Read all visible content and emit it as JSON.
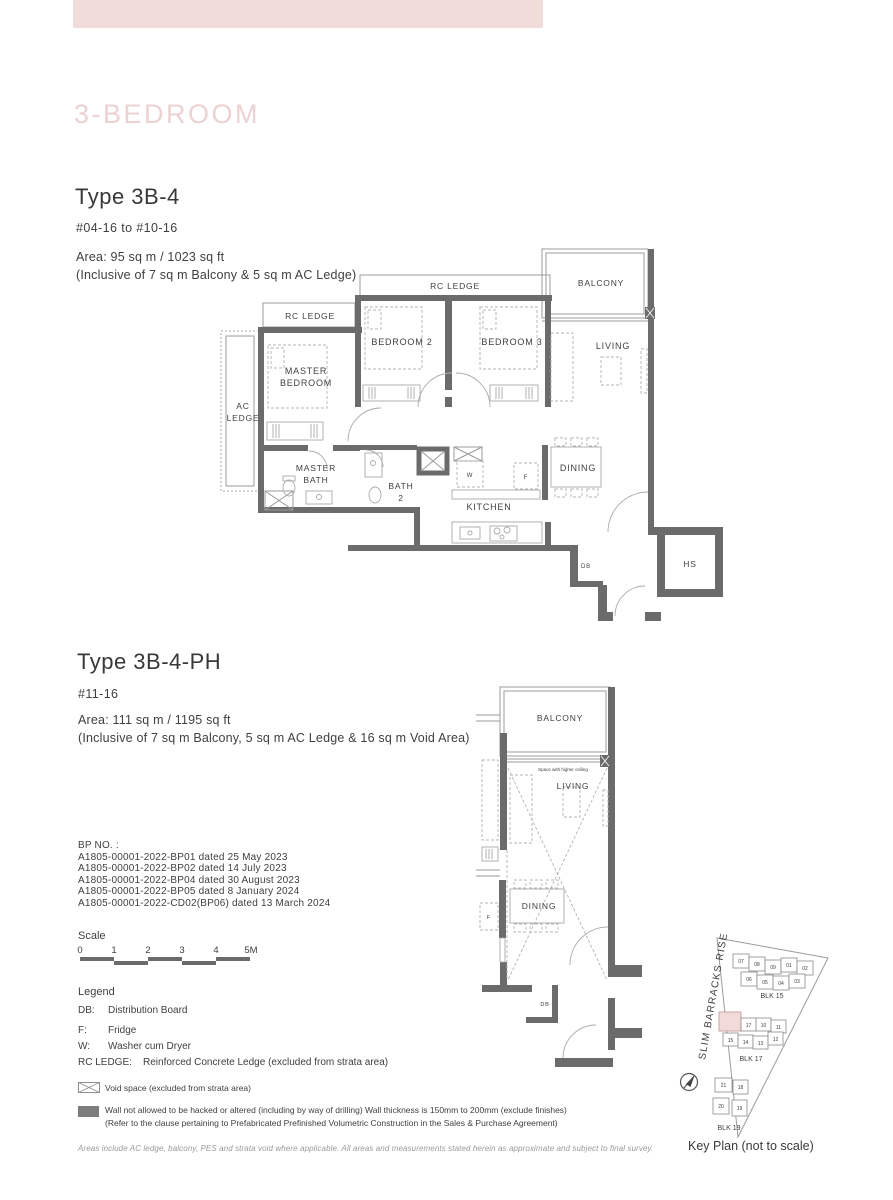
{
  "page": {
    "category_title": "3-BEDROOM",
    "footer_note": "Areas include AC ledge, balcony, PES and strata void where applicable. All areas and measurements stated herein as approximate and subject to final survey."
  },
  "unit1": {
    "title": "Type 3B-4",
    "levels": "#04-16 to #10-16",
    "area_line1": "Area: 95 sq m / 1023 sq ft",
    "area_line2": "(Inclusive of 7 sq m Balcony & 5 sq m AC Ledge)"
  },
  "unit2": {
    "title": "Type 3B-4-PH",
    "levels": "#11-16",
    "area_line1": "Area: 111 sq m / 1195 sq ft",
    "area_line2": "(Inclusive of 7 sq m Balcony, 5 sq m AC Ledge & 16 sq m Void Area)"
  },
  "plan1": {
    "rc_ledge_top": "RC LEDGE",
    "rc_ledge_left": "RC LEDGE",
    "balcony": "BALCONY",
    "ac_1": "AC",
    "ac_2": "LEDGE",
    "master_1": "MASTER",
    "master_2": "BEDROOM",
    "bedroom2": "BEDROOM 2",
    "bedroom3": "BEDROOM 3",
    "living": "LIVING",
    "mbath_1": "MASTER",
    "mbath_2": "BATH",
    "bath2_1": "BATH",
    "bath2_2": "2",
    "w": "W",
    "f": "F",
    "dining": "DINING",
    "kitchen": "KITCHEN",
    "db": "DB",
    "hs": "HS"
  },
  "plan2": {
    "balcony": "BALCONY",
    "higher_ceiling": "Space with higher ceiling",
    "living": "LIVING",
    "dining": "DINING",
    "f": "F",
    "db": "DB"
  },
  "bp": {
    "heading": "BP NO. :",
    "lines": [
      "A1805-00001-2022-BP01 dated 25 May 2023",
      "A1805-00001-2022-BP02 dated 14 July 2023",
      "A1805-00001-2022-BP04 dated 30 August 2023",
      "A1805-00001-2022-BP05 dated 8 January 2024",
      "A1805-00001-2022-CD02(BP06) dated 13 March 2024"
    ]
  },
  "scale": {
    "heading": "Scale",
    "ticks": [
      "0",
      "1",
      "2",
      "3",
      "4",
      "5M"
    ]
  },
  "legend": {
    "heading": "Legend",
    "items": [
      {
        "key": "DB:",
        "value": "Distribution Board"
      },
      {
        "key": "F:",
        "value": "Fridge"
      },
      {
        "key": "W:",
        "value": "Washer cum Dryer"
      },
      {
        "key": "RC LEDGE:",
        "value": "Reinforced Concrete Ledge (excluded from strata area)"
      }
    ]
  },
  "notes": {
    "void": "Void space (excluded from strata area)",
    "wall_1": "Wall not allowed to be hacked or altered (including by way of drilling) Wall thickness is 150mm to 200mm (exclude finishes)",
    "wall_2": "(Refer to the clause pertaining to Prefabricated Prefinished Volumetric Construction in the Sales & Purchase Agreement)"
  },
  "keyplan": {
    "road_label": "SLIM BARRACKS RISE",
    "caption": "Key Plan (not to scale)",
    "blk15_label": "BLK 15",
    "blk15_row1": [
      "07",
      "08",
      "09",
      "01",
      "02"
    ],
    "blk15_row2": [
      "06",
      "05",
      "04",
      "03"
    ],
    "blk17_label": "BLK 17",
    "blk17_row1": [
      "17",
      "10",
      "11"
    ],
    "blk17_row2": [
      "15",
      "14",
      "13",
      "12"
    ],
    "blk19_label": "BLK 19",
    "blk19_row1": [
      "21",
      "18"
    ],
    "blk19_row2": [
      "20",
      "19"
    ]
  },
  "colors": {
    "wall": "#6b6b6b",
    "band": "#f2dcda",
    "title_pink": "#ecd2d2",
    "highlight": "#f3dada"
  }
}
